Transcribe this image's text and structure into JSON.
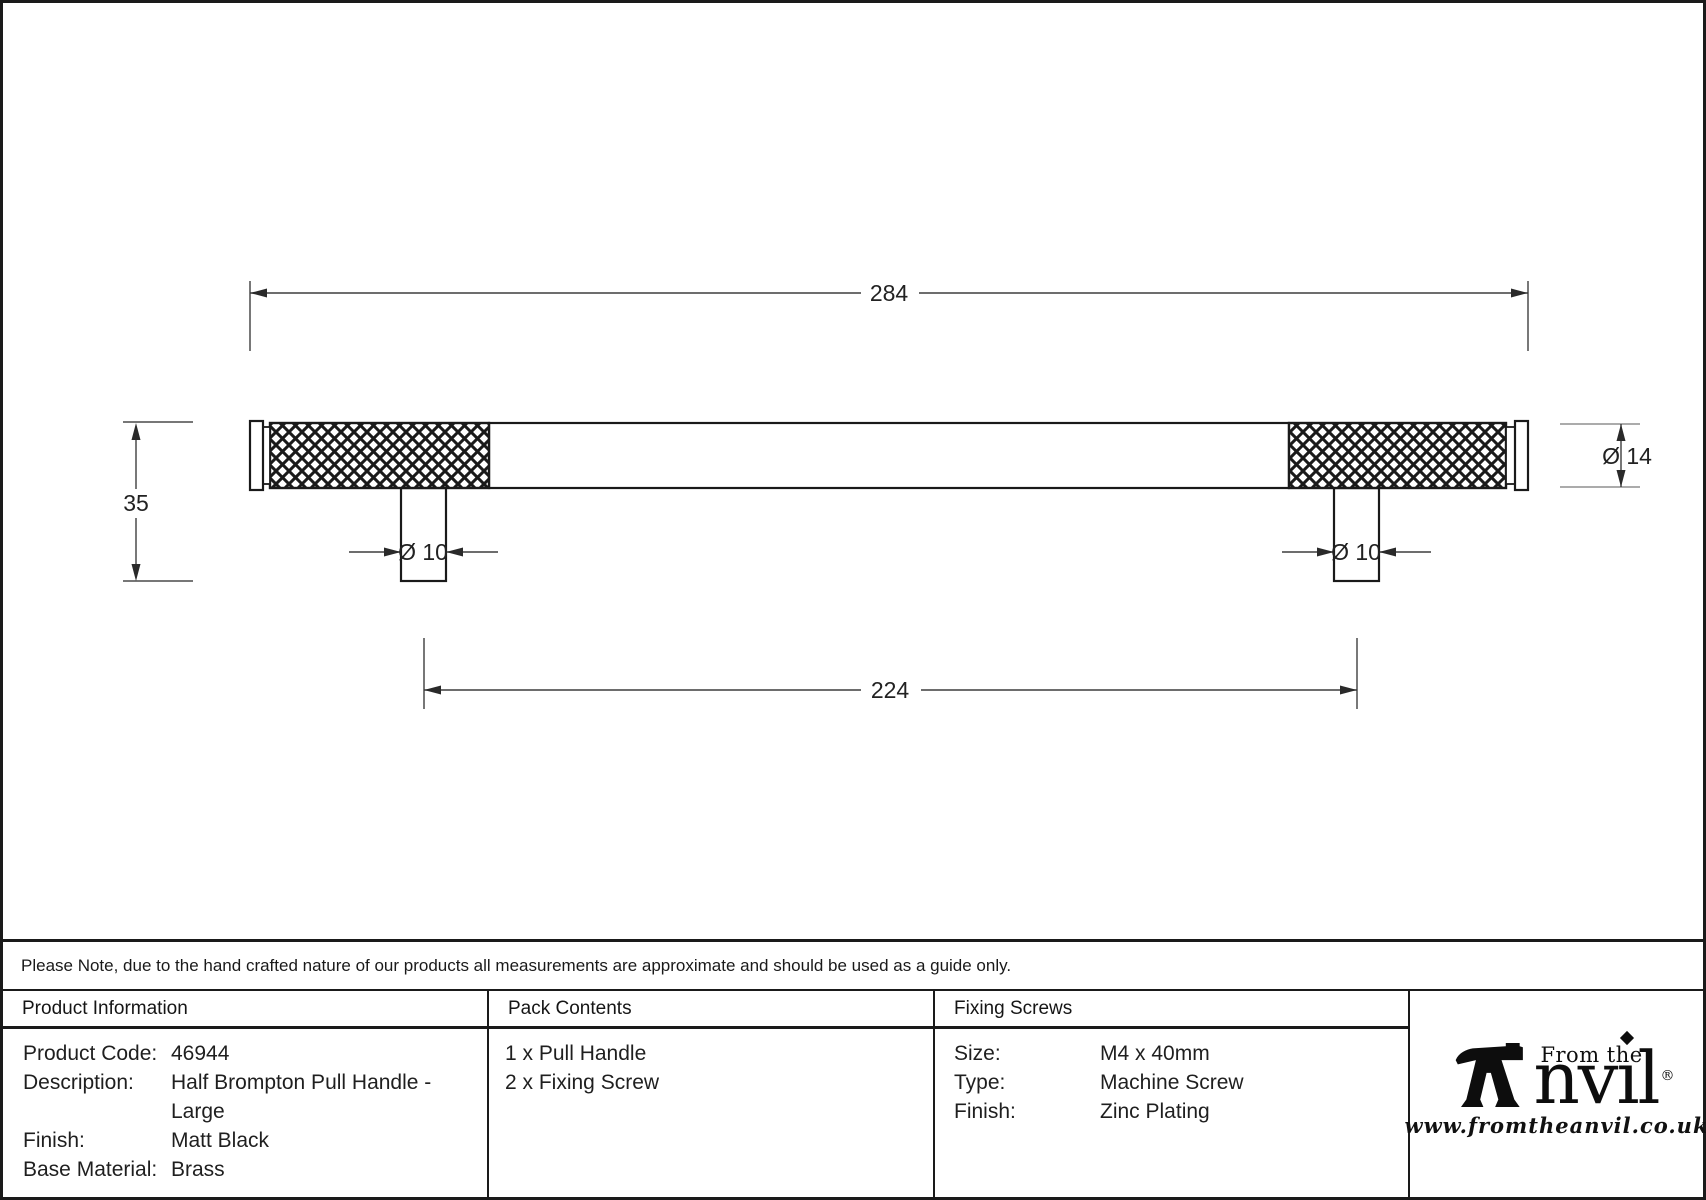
{
  "drawing": {
    "overall_length": "284",
    "fixing_centres": "224",
    "projection_height": "35",
    "bar_diameter": "Ø 14",
    "stem_diameter_left": "Ø 10",
    "stem_diameter_right": "Ø 10"
  },
  "note": "Please Note, due to the hand crafted nature of our products all measurements are approximate and should be used as a guide only.",
  "product_information": {
    "header": "Product Information",
    "rows": [
      {
        "label": "Product Code:",
        "value": "46944"
      },
      {
        "label": "Description:",
        "value": "Half Brompton Pull Handle - Large"
      },
      {
        "label": "Finish:",
        "value": "Matt Black"
      },
      {
        "label": "Base Material:",
        "value": "Brass"
      }
    ]
  },
  "pack_contents": {
    "header": "Pack Contents",
    "items": [
      "1 x Pull Handle",
      "2 x Fixing Screw"
    ]
  },
  "fixing_screws": {
    "header": "Fixing Screws",
    "rows": [
      {
        "label": "Size:",
        "value": "M4 x 40mm"
      },
      {
        "label": "Type:",
        "value": "Machine Screw"
      },
      {
        "label": "Finish:",
        "value": "Zinc Plating"
      }
    ]
  },
  "logo": {
    "tagline": "From the",
    "brand_nv": "nv",
    "brand_i": "ı",
    "brand_l": "l",
    "registered": "®",
    "website": "www.fromtheanvil.co.uk"
  },
  "colors": {
    "outline": "#1a1a1a",
    "dim_line": "#3d3d3d",
    "ref_line_light": "#8f8f8f"
  }
}
